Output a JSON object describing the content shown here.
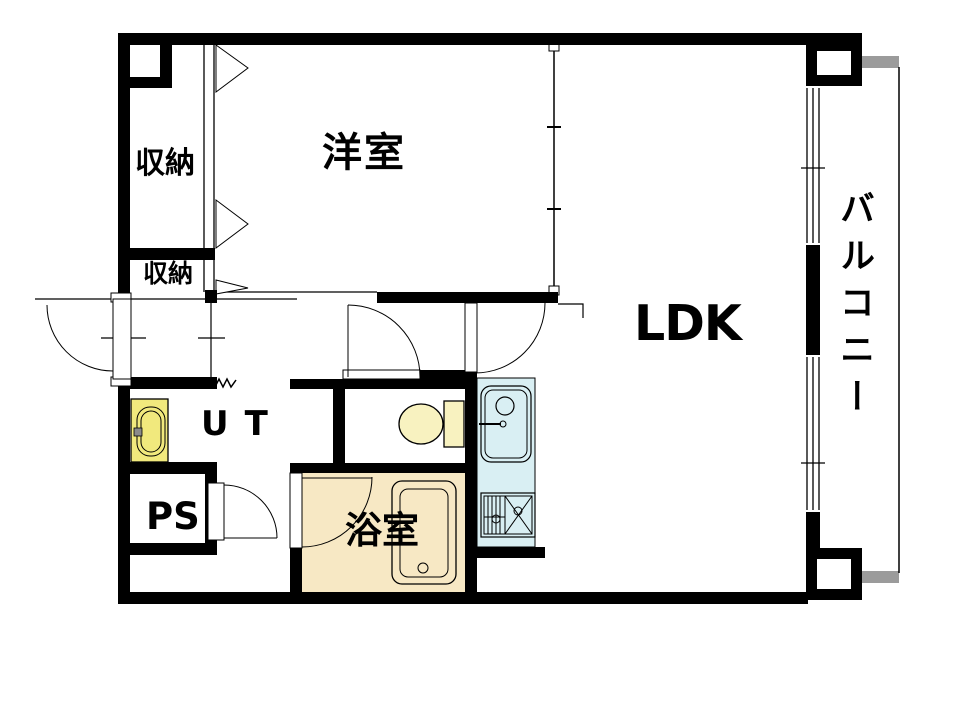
{
  "title": "apartment-floor-plan",
  "rooms": {
    "bedroom": {
      "label": "洋室"
    },
    "ldk": {
      "label": "LDK"
    },
    "balcony": {
      "label": "バルコニー"
    },
    "closet_upper": {
      "label": "収納"
    },
    "closet_lower": {
      "label": "収納"
    },
    "utility": {
      "label": "UT"
    },
    "pipe_space": {
      "label": "PS"
    },
    "bathroom": {
      "label": "浴室"
    }
  },
  "fixtures": [
    "entrance-door-icon",
    "bathtub-icon",
    "toilet-icon",
    "vanity-sink-icon",
    "kitchen-sink-icon",
    "faucet-icon",
    "gas-stove-icon",
    "closet-folding-door-icon",
    "window-icon",
    "balcony-divider-icon",
    "door-swing-arc-icon",
    "break-line-zigzag-icon"
  ],
  "colors": {
    "wall": "#000000",
    "bathroom_fill": "#f7e8c4",
    "fixture_yellow": "#f1e97d",
    "toilet_yellow": "#f8f2c0",
    "kitchen_fill": "#d9eff3",
    "balcony_divider_gray": "#9b9b9b",
    "background": "#ffffff"
  }
}
